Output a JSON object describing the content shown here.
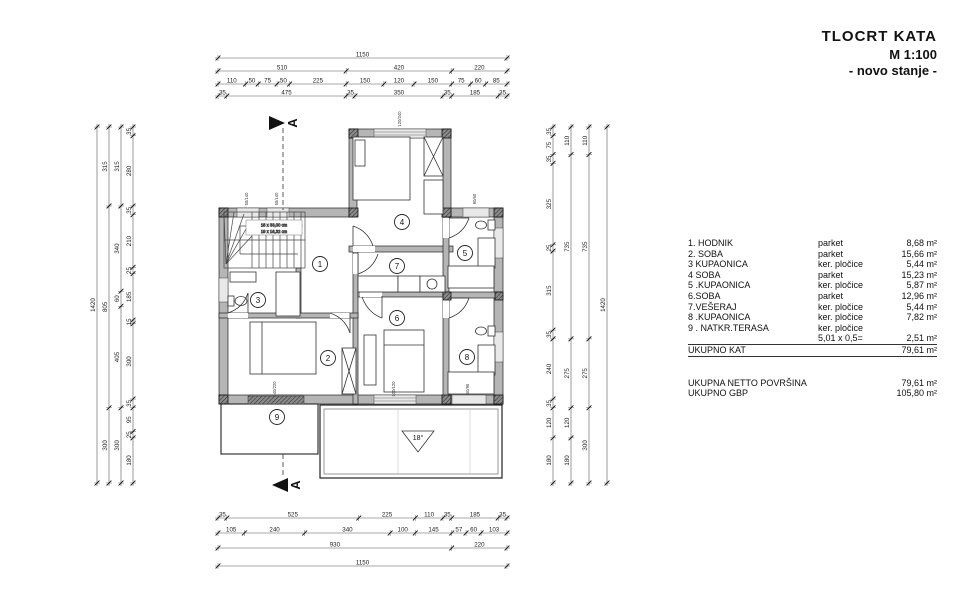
{
  "title_block": {
    "project": "TLOCRT  KATA",
    "scale": "M 1:100",
    "state": "- novo stanje -"
  },
  "legend": {
    "rows": [
      {
        "name": "1. HODNIK",
        "material": "parket",
        "area": "8,68  m²"
      },
      {
        "name": "2. SOBA",
        "material": "parket",
        "area": "15,66 m²"
      },
      {
        "name": "3  KUPAONICA",
        "material": "ker. pločice",
        "area": "5,44 m²"
      },
      {
        "name": "4  SOBA",
        "material": "parket",
        "area": "15,23 m²"
      },
      {
        "name": "5 .KUPAONICA",
        "material": "ker. pločice",
        "area": "5,87 m²"
      },
      {
        "name": "6.SOBA",
        "material": "parket",
        "area": "12,96 m²"
      },
      {
        "name": "7.VEŠERAJ",
        "material": "ker. pločice",
        "area": "5,44 m²"
      },
      {
        "name": "8 .KUPAONICA",
        "material": "ker. pločice",
        "area": "7,82 m²"
      },
      {
        "name": "9 . NATKR.TERASA",
        "material": "ker. pločice",
        "area": ""
      }
    ],
    "subtotal": {
      "formula": "5,01 x 0,5=",
      "area": "2,51 m²"
    },
    "total": {
      "label": "UKUPNO KAT",
      "area": "79,61  m²"
    },
    "summary": [
      {
        "label": "UKUPNA NETTO POVRŠINA",
        "area": "79,61  m²"
      },
      {
        "label": "UKUPNO GBP",
        "area": "105,80  m²"
      }
    ]
  },
  "plan": {
    "room_numbers": [
      "1",
      "2",
      "3",
      "4",
      "5",
      "6",
      "7",
      "8",
      "9"
    ],
    "section_label": "A",
    "roof_slope": "18°",
    "stairs": {
      "line1": "18 x 33,00 cm",
      "line2": "19 x 16,32 cm"
    },
    "window_labels": [
      "50/140",
      "50/140",
      "120/240",
      "90/60",
      "240/220",
      "100/120",
      "60/90"
    ]
  },
  "dimensions": {
    "top_total": 1150,
    "side_total": 1420,
    "top_rows": [
      [
        1150
      ],
      [
        510,
        420,
        220
      ],
      [
        110,
        50,
        75,
        50,
        225,
        150,
        120,
        150,
        75,
        60,
        85
      ],
      [
        35,
        475,
        35,
        350,
        35,
        185,
        35
      ]
    ],
    "bottom_rows": [
      [
        35,
        525,
        225,
        110,
        35,
        185,
        35
      ],
      [
        105,
        240,
        340,
        100,
        145,
        57,
        60,
        103
      ],
      [
        930,
        220
      ],
      [
        1150
      ]
    ],
    "left_chains": [
      [
        1420
      ],
      [
        315,
        805,
        300
      ],
      [
        315,
        340,
        60,
        405,
        300
      ],
      [
        35,
        280,
        35,
        210,
        25,
        185,
        15,
        300,
        35,
        95,
        25,
        180
      ]
    ],
    "right_chains": [
      [
        35,
        75,
        35,
        325,
        25,
        315,
        35,
        240,
        35,
        120,
        180
      ],
      [
        110,
        735,
        275,
        120,
        180
      ],
      [
        110,
        735,
        275,
        300
      ],
      [
        1420
      ]
    ]
  },
  "colors": {
    "line": "#222222",
    "wall_fill": "#b5b5b5",
    "window_fill": "#e8e8e8",
    "paper": "#ffffff"
  }
}
